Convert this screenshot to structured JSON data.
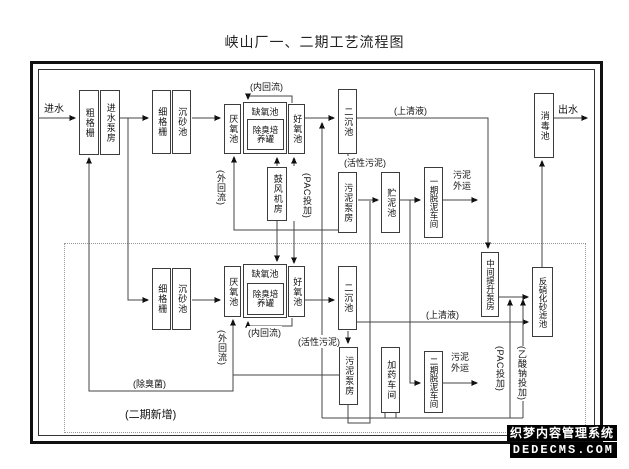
{
  "title": "峡山厂一、二期工艺流程图",
  "phase1": {
    "inflow": "进水",
    "coarse_screen": "粗格栅",
    "inlet_pump_house": "进水泵房",
    "fine_screen": "细格栅",
    "grit_chamber": "沉砂池",
    "anaerobic_tank": "厌氧池",
    "anoxic_tank": "缺氧池",
    "deodor_culture_tank": "除臭培养罐",
    "aerobic_tank": "好氧池",
    "secondary_clarifier": "二沉池",
    "internal_recycle": "(内回流)",
    "external_recycle": "(外回流)",
    "blower_house": "鼓风机房",
    "pac_dosing": "(PAC投加)",
    "supernatant": "(上清液)",
    "activated_sludge": "(活性污泥)",
    "sludge_pump_house": "污泥泵房",
    "sludge_storage_tank": "贮泥池",
    "dewatering_workshop": "一期脱泥车间",
    "sludge_out": "污泥外运",
    "disinfection_tank": "消毒池",
    "outflow": "出水"
  },
  "phase2": {
    "fine_screen": "细格栅",
    "grit_chamber": "沉砂池",
    "anaerobic_tank": "厌氧池",
    "anoxic_tank": "缺氧池",
    "deodor_culture_tank": "除臭培养罐",
    "aerobic_tank": "好氧池",
    "secondary_clarifier": "二沉池",
    "internal_recycle": "(内回流)",
    "external_recycle": "(外回流)",
    "activated_sludge": "(活性污泥)",
    "supernatant": "(上清液)",
    "sludge_pump_house": "污泥泵房",
    "dosing_workshop": "加药车间",
    "dewatering_workshop": "二期脱泥车间",
    "sludge_out": "污泥外运",
    "intermediate_lift_pump_house": "中间提升泵房",
    "denitrification_sand_filter": "反硝化砂滤池",
    "pac_dosing": "(PAC投加)",
    "sodium_acetate_dosing": "(乙酸钠投加)",
    "deodor_bacteria": "(除臭菌)",
    "phase2_new": "(二期新增)"
  },
  "watermark": {
    "line1": "织梦内容管理系统",
    "line2": "DEDECMS.COM"
  }
}
